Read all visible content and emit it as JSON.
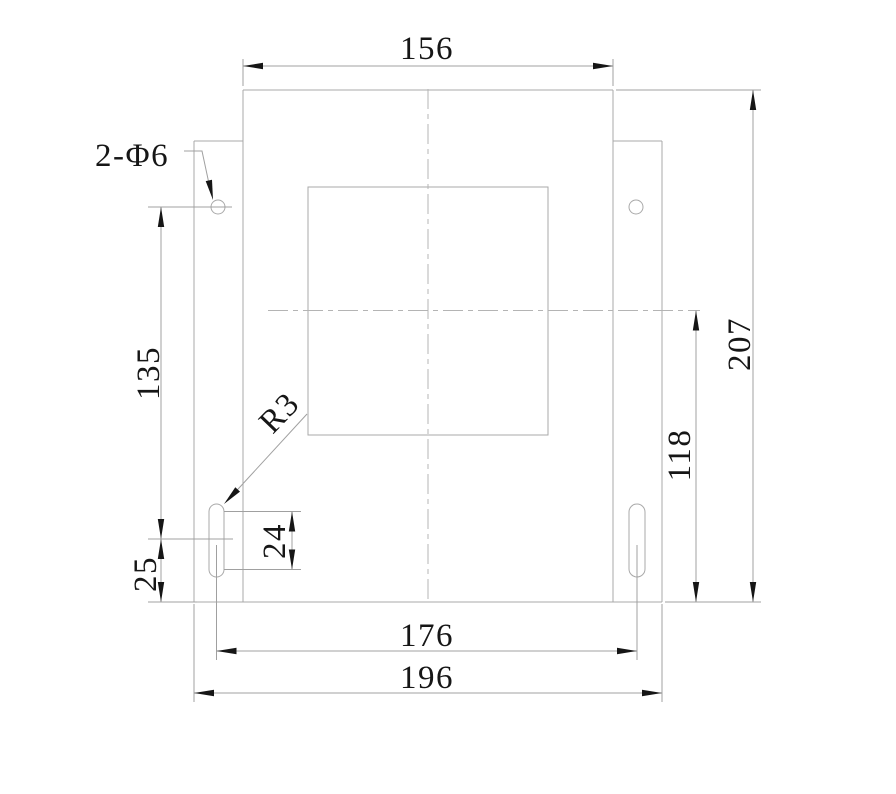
{
  "drawing_title": "mounting plate dimensional drawing",
  "labels": {
    "top_width": "156",
    "overall_height": "207",
    "center_height": "118",
    "hole_to_slot": "135",
    "slot_to_bottom": "25",
    "slot_length": "24",
    "slot_spacing": "176",
    "overall_width": "196",
    "hole_callout": "2-Φ6",
    "slot_radius_callout": "R3"
  },
  "style": {
    "geometry_color": "#a9a9a9",
    "dimension_color": "#a0a0a0",
    "centerline_color": "#b4b4b4",
    "ink_color": "#161616",
    "background": "#ffffff",
    "font_size": 33,
    "centerline_dash": "20 5 5 5",
    "arrow_length": 20,
    "arrow_half_width": 3.2
  },
  "geometry": {
    "outline_lines": [
      {
        "name": "plate-top-edge",
        "x1": 243,
        "y1": 90,
        "x2": 613,
        "y2": 90
      },
      {
        "name": "plate-left-edge",
        "x1": 243,
        "y1": 90,
        "x2": 243,
        "y2": 602
      },
      {
        "name": "plate-right-edge",
        "x1": 613,
        "y1": 90,
        "x2": 613,
        "y2": 602
      },
      {
        "name": "plate-bottom-edge",
        "x1": 194,
        "y1": 602,
        "x2": 662,
        "y2": 602
      },
      {
        "name": "left-flange-top-edge",
        "x1": 194,
        "y1": 141,
        "x2": 243,
        "y2": 141
      },
      {
        "name": "left-flange-left-edge",
        "x1": 194,
        "y1": 141,
        "x2": 194,
        "y2": 602
      },
      {
        "name": "right-flange-top-edge",
        "x1": 613,
        "y1": 141,
        "x2": 662,
        "y2": 141
      },
      {
        "name": "right-flange-right-edge",
        "x1": 662,
        "y1": 141,
        "x2": 662,
        "y2": 602
      }
    ],
    "inner_opening": {
      "name": "inner-opening",
      "x": 308,
      "y": 187,
      "w": 240,
      "h": 248
    },
    "slots": [
      {
        "name": "mounting-slot-left",
        "x": 209,
        "y": 504,
        "w": 15,
        "h": 73,
        "rx": 7.5
      },
      {
        "name": "mounting-slot-right",
        "x": 629,
        "y": 504,
        "w": 16,
        "h": 73,
        "rx": 8
      }
    ],
    "holes": [
      {
        "name": "mounting-hole-left",
        "cx": 218,
        "cy": 207,
        "r": 7
      },
      {
        "name": "mounting-hole-right",
        "cx": 636,
        "cy": 207,
        "r": 7
      }
    ],
    "centerlines": [
      {
        "name": "vertical-centerline",
        "x1": 428,
        "y1": 89,
        "x2": 428,
        "y2": 602
      },
      {
        "name": "horizontal-centerline",
        "x1": 268,
        "y1": 310.5,
        "x2": 700,
        "y2": 310.5
      }
    ],
    "extension_lines": [
      {
        "x1": 243,
        "y1": 86,
        "x2": 243,
        "y2": 59
      },
      {
        "x1": 613,
        "y1": 86,
        "x2": 613,
        "y2": 59
      },
      {
        "x1": 616,
        "y1": 90,
        "x2": 761,
        "y2": 90
      },
      {
        "x1": 665,
        "y1": 602,
        "x2": 761,
        "y2": 602
      },
      {
        "x1": 148,
        "y1": 207,
        "x2": 232,
        "y2": 207
      },
      {
        "x1": 148,
        "y1": 539,
        "x2": 233,
        "y2": 539
      },
      {
        "x1": 148,
        "y1": 602,
        "x2": 197,
        "y2": 602
      },
      {
        "x1": 224,
        "y1": 511.5,
        "x2": 301,
        "y2": 511.5
      },
      {
        "x1": 224,
        "y1": 569.5,
        "x2": 301,
        "y2": 569.5
      },
      {
        "x1": 216.5,
        "y1": 545,
        "x2": 216.5,
        "y2": 660
      },
      {
        "x1": 637,
        "y1": 545,
        "x2": 637,
        "y2": 660
      },
      {
        "x1": 194,
        "y1": 604,
        "x2": 194,
        "y2": 702
      },
      {
        "x1": 662,
        "y1": 604,
        "x2": 662,
        "y2": 702
      }
    ],
    "dimensions": [
      {
        "name": "dimension-156",
        "label_key": "top_width",
        "x1": 243,
        "y1": 66,
        "x2": 613,
        "y2": 66,
        "arrows": [
          {
            "x": 243,
            "y": 66,
            "a": 180
          },
          {
            "x": 613,
            "y": 66,
            "a": 0
          }
        ],
        "label": {
          "x": 427,
          "y": 59,
          "rot": 0,
          "anchor": "middle"
        }
      },
      {
        "name": "dimension-207",
        "label_key": "overall_height",
        "x1": 753,
        "y1": 90,
        "x2": 753,
        "y2": 602,
        "arrows": [
          {
            "x": 753,
            "y": 90,
            "a": -90
          },
          {
            "x": 753,
            "y": 602,
            "a": 90
          }
        ],
        "label": {
          "x": 750,
          "y": 344,
          "rot": -90,
          "anchor": "middle"
        }
      },
      {
        "name": "dimension-118",
        "label_key": "center_height",
        "x1": 696,
        "y1": 310.5,
        "x2": 696,
        "y2": 602,
        "arrows": [
          {
            "x": 696,
            "y": 310.5,
            "a": -90
          },
          {
            "x": 696,
            "y": 602,
            "a": 90
          }
        ],
        "label": {
          "x": 690,
          "y": 455,
          "rot": -90,
          "anchor": "middle"
        }
      },
      {
        "name": "dimension-135",
        "label_key": "hole_to_slot",
        "x1": 161,
        "y1": 207,
        "x2": 161,
        "y2": 539,
        "arrows": [
          {
            "x": 161,
            "y": 207,
            "a": -90
          },
          {
            "x": 161,
            "y": 539,
            "a": 90
          }
        ],
        "label": {
          "x": 159,
          "y": 373,
          "rot": -90,
          "anchor": "middle"
        }
      },
      {
        "name": "dimension-25",
        "label_key": "slot_to_bottom",
        "x1": 161,
        "y1": 539,
        "x2": 161,
        "y2": 602,
        "arrows": [
          {
            "x": 161,
            "y": 539,
            "a": -90
          },
          {
            "x": 161,
            "y": 602,
            "a": 90
          }
        ],
        "label": {
          "x": 156,
          "y": 574,
          "rot": -90,
          "anchor": "middle"
        }
      },
      {
        "name": "dimension-24",
        "label_key": "slot_length",
        "x1": 292,
        "y1": 511.5,
        "x2": 292,
        "y2": 569.5,
        "arrows": [
          {
            "x": 292,
            "y": 511.5,
            "a": -90
          },
          {
            "x": 292,
            "y": 569.5,
            "a": 90
          }
        ],
        "label": {
          "x": 285,
          "y": 541,
          "rot": -90,
          "anchor": "middle"
        }
      },
      {
        "name": "dimension-176",
        "label_key": "slot_spacing",
        "x1": 216.5,
        "y1": 651,
        "x2": 637,
        "y2": 651,
        "arrows": [
          {
            "x": 216.5,
            "y": 651,
            "a": 180
          },
          {
            "x": 637,
            "y": 651,
            "a": 0
          }
        ],
        "label": {
          "x": 427,
          "y": 646,
          "rot": 0,
          "anchor": "middle"
        }
      },
      {
        "name": "dimension-196",
        "label_key": "overall_width",
        "x1": 194,
        "y1": 693,
        "x2": 662,
        "y2": 693,
        "arrows": [
          {
            "x": 194,
            "y": 693,
            "a": 180
          },
          {
            "x": 662,
            "y": 693,
            "a": 0
          }
        ],
        "label": {
          "x": 427,
          "y": 688,
          "rot": 0,
          "anchor": "middle"
        }
      }
    ],
    "leaders": [
      {
        "name": "leader-hole-callout",
        "label_key": "hole_callout",
        "points": "184,151 202,151 211,193",
        "arrow": {
          "x": 213,
          "y": 200,
          "a": 78
        },
        "label": {
          "x": 95,
          "y": 166,
          "rot": 0,
          "anchor": "start"
        }
      },
      {
        "name": "leader-slot-radius",
        "label_key": "slot_radius_callout",
        "points": "307,414 228,500",
        "arrow": {
          "x": 224,
          "y": 504,
          "a": 133
        },
        "label": {
          "x": 287,
          "y": 420,
          "rot": -46,
          "anchor": "middle"
        }
      }
    ]
  }
}
